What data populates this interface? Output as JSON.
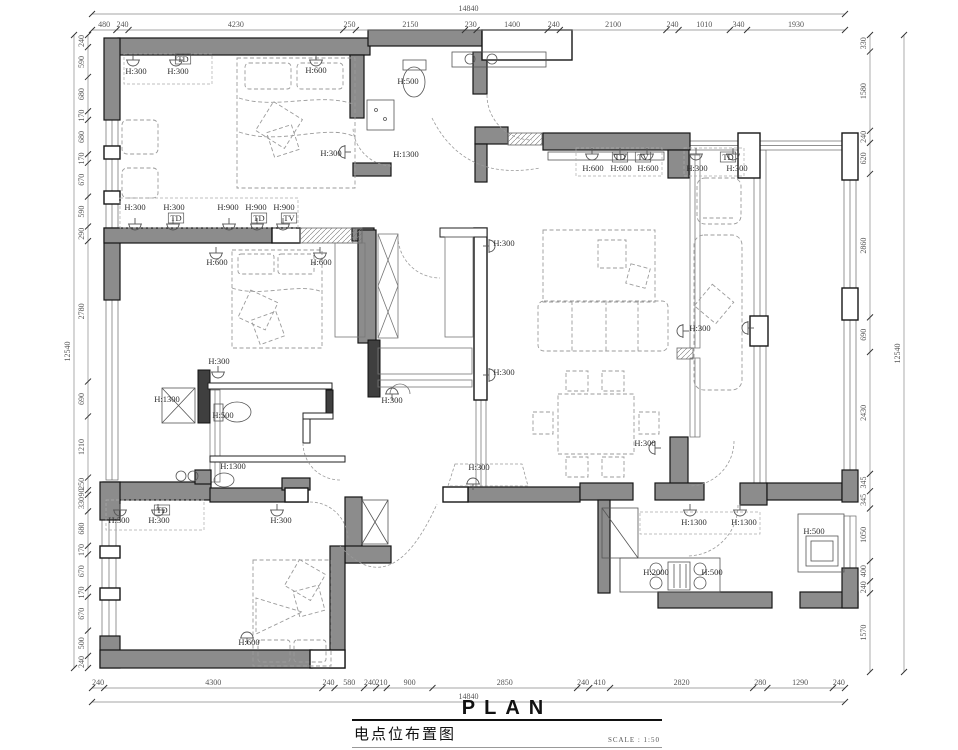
{
  "title": {
    "plan": "PLAN",
    "sheet_name_cn": "电点位布置图",
    "scale_label": "SCALE : 1:50"
  },
  "dims": {
    "top": {
      "overall": "14840",
      "segments": [
        "480",
        "240",
        "4230",
        "250",
        "2150",
        "230",
        "1400",
        "240",
        "2100",
        "240",
        "1010",
        "340",
        "1930"
      ]
    },
    "bottom": {
      "overall": "14840",
      "segments": [
        "240",
        "4300",
        "240",
        "580",
        "240",
        "210",
        "900",
        "2850",
        "240",
        "410",
        "2820",
        "280",
        "1290",
        "240"
      ]
    },
    "left": {
      "overall": "12540",
      "segments": [
        "240",
        "590",
        "680",
        "170",
        "680",
        "170",
        "670",
        "590",
        "290",
        "2780",
        "690",
        "1210",
        "250",
        "90",
        "330",
        "680",
        "170",
        "670",
        "170",
        "670",
        "500",
        "240"
      ]
    },
    "right": {
      "overall": "12540",
      "segments": [
        "330",
        "1580",
        "240",
        "620",
        "2860",
        "690",
        "2430",
        "345",
        "345",
        "1050",
        "400",
        "240",
        "1570"
      ]
    }
  },
  "point_labels": [
    {
      "t": "H:300",
      "x": 136,
      "y": 74
    },
    {
      "t": "H:300",
      "x": 178,
      "y": 74
    },
    {
      "t": "TD",
      "x": 183,
      "y": 62,
      "b": 1
    },
    {
      "t": "H:600",
      "x": 316,
      "y": 73
    },
    {
      "t": "H:500",
      "x": 408,
      "y": 84
    },
    {
      "t": "H:300",
      "x": 331,
      "y": 156
    },
    {
      "t": "H:1300",
      "x": 406,
      "y": 157
    },
    {
      "t": "H:300",
      "x": 135,
      "y": 210
    },
    {
      "t": "H:300",
      "x": 174,
      "y": 210
    },
    {
      "t": "TD",
      "x": 176,
      "y": 221,
      "b": 1
    },
    {
      "t": "H:900",
      "x": 228,
      "y": 210
    },
    {
      "t": "H:900",
      "x": 256,
      "y": 210
    },
    {
      "t": "H:900",
      "x": 284,
      "y": 210
    },
    {
      "t": "TD",
      "x": 259,
      "y": 221,
      "b": 1
    },
    {
      "t": "TV",
      "x": 289,
      "y": 221,
      "b": 1
    },
    {
      "t": "H:600",
      "x": 217,
      "y": 265
    },
    {
      "t": "H:600",
      "x": 321,
      "y": 265
    },
    {
      "t": "H:300",
      "x": 219,
      "y": 364
    },
    {
      "t": "H:1300",
      "x": 167,
      "y": 402
    },
    {
      "t": "H:500",
      "x": 223,
      "y": 418
    },
    {
      "t": "H:1300",
      "x": 233,
      "y": 469
    },
    {
      "t": "H:300",
      "x": 504,
      "y": 246
    },
    {
      "t": "H:300",
      "x": 504,
      "y": 375
    },
    {
      "t": "H:300",
      "x": 392,
      "y": 403
    },
    {
      "t": "TD",
      "x": 620,
      "y": 160,
      "b": 1
    },
    {
      "t": "TV",
      "x": 643,
      "y": 160,
      "b": 1
    },
    {
      "t": "H:600",
      "x": 593,
      "y": 171
    },
    {
      "t": "H:600",
      "x": 621,
      "y": 171
    },
    {
      "t": "H:600",
      "x": 648,
      "y": 171
    },
    {
      "t": "TD",
      "x": 728,
      "y": 160,
      "b": 1
    },
    {
      "t": "H:300",
      "x": 697,
      "y": 171
    },
    {
      "t": "H:300",
      "x": 737,
      "y": 171
    },
    {
      "t": "H:300",
      "x": 700,
      "y": 331
    },
    {
      "t": "H:300",
      "x": 645,
      "y": 446
    },
    {
      "t": "H:300",
      "x": 479,
      "y": 470
    },
    {
      "t": "H:300",
      "x": 119,
      "y": 523
    },
    {
      "t": "H:300",
      "x": 159,
      "y": 523
    },
    {
      "t": "TD",
      "x": 162,
      "y": 513,
      "b": 1
    },
    {
      "t": "H:300",
      "x": 281,
      "y": 523
    },
    {
      "t": "H:600",
      "x": 249,
      "y": 645
    },
    {
      "t": "H:1300",
      "x": 694,
      "y": 525
    },
    {
      "t": "H:1300",
      "x": 744,
      "y": 525
    },
    {
      "t": "H:500",
      "x": 814,
      "y": 534
    },
    {
      "t": "H:2000",
      "x": 656,
      "y": 575
    },
    {
      "t": "H:500",
      "x": 712,
      "y": 575
    }
  ],
  "colors": {
    "wall_fill": "#8c8c8c",
    "wall_stroke": "#161616",
    "dim_text": "#555555",
    "label_text": "#2e2e2e",
    "dashed_furniture": "#9b9b9b"
  }
}
